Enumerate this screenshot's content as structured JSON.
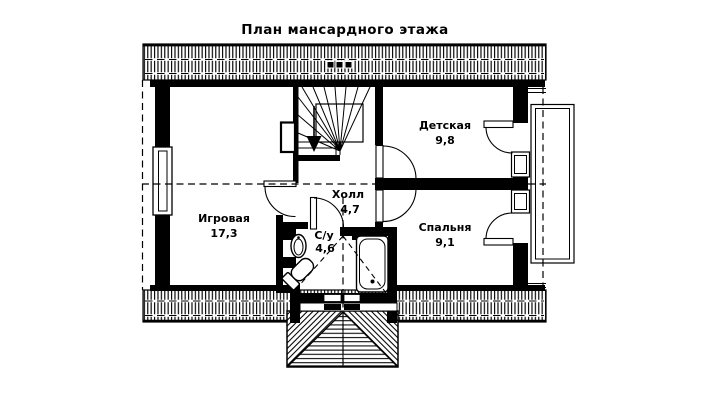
{
  "title": "План мансардного этажа",
  "plan": {
    "rooms": [
      {
        "name": "Игровая",
        "area": "17,3"
      },
      {
        "name": "Холл",
        "area": "4,7"
      },
      {
        "name": "С/у",
        "area": "4,6"
      },
      {
        "name": "Детская",
        "area": "9,8"
      },
      {
        "name": "Спальня",
        "area": "9,1"
      }
    ]
  },
  "colors": {
    "ink": "#000000",
    "paper": "#ffffff"
  }
}
